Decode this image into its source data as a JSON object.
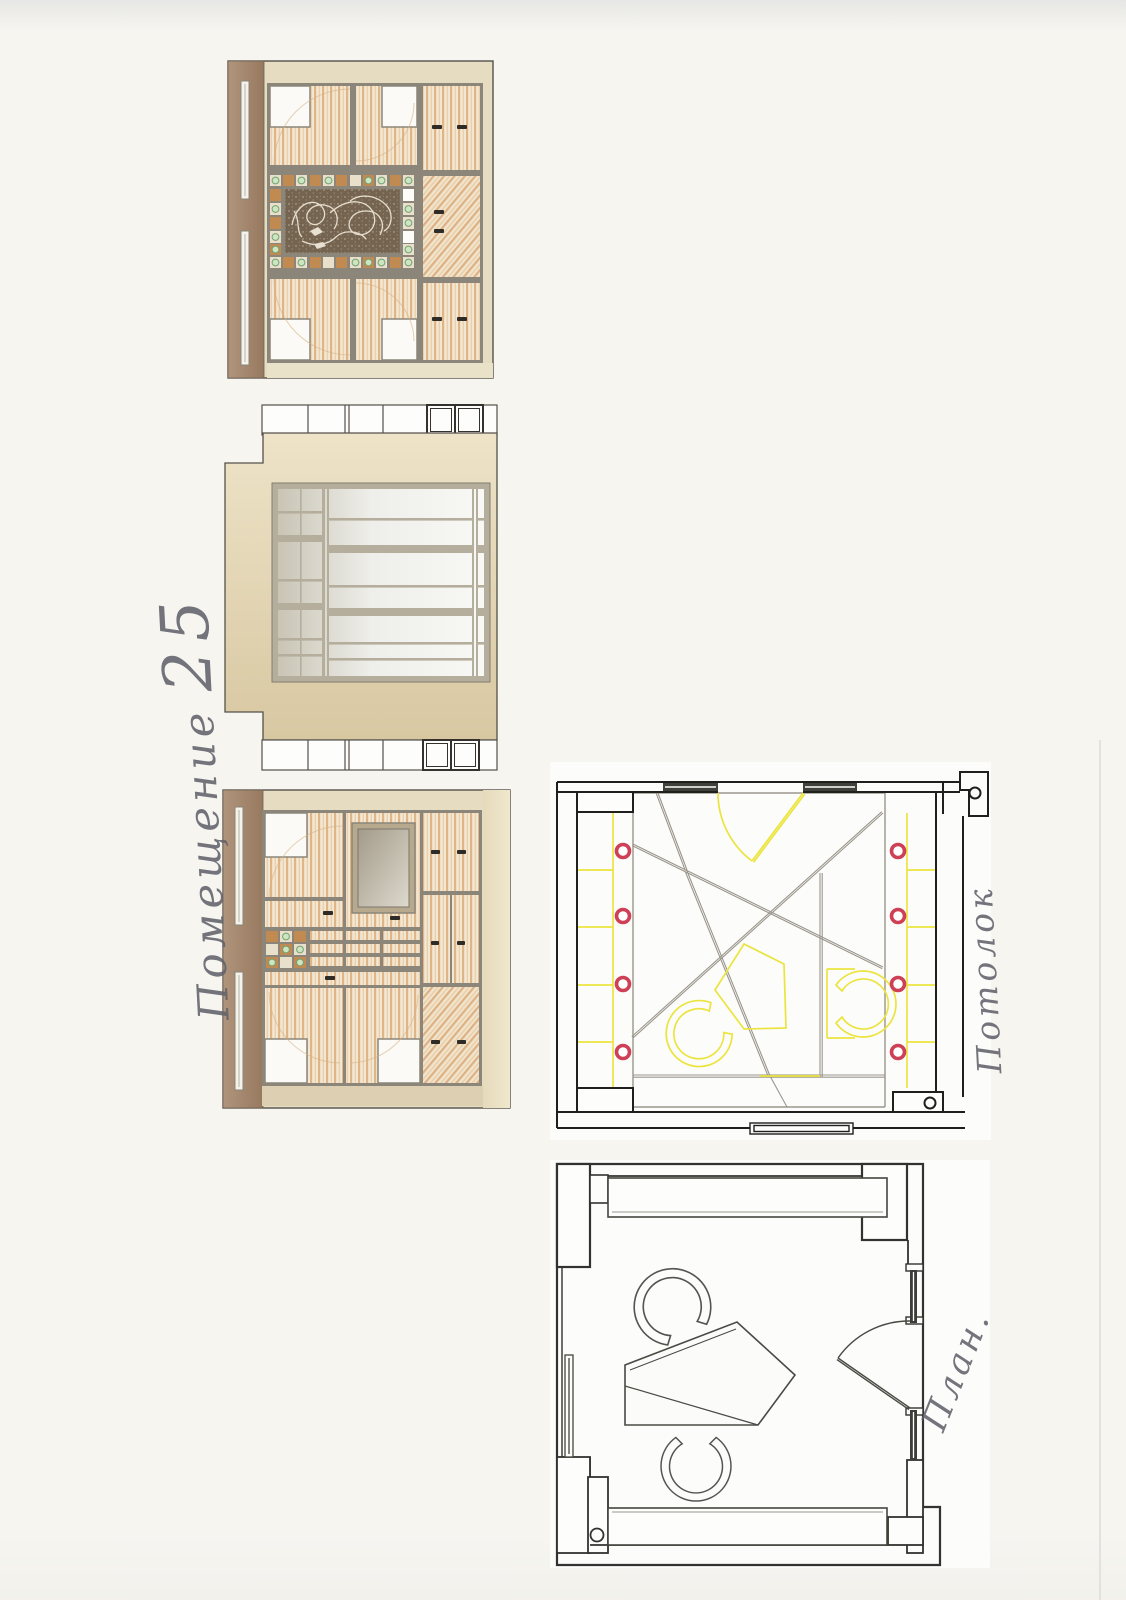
{
  "sheet": {
    "title_word": "Помещение",
    "title_number": "25",
    "ceiling_label": "Потолок",
    "plan_label": "План."
  },
  "colors": {
    "paper": "#f6f5f0",
    "scan_edge": "#e6e6e4",
    "band_brown": "#a58a71",
    "wall_beige_light": "#eee3c8",
    "wall_beige_dark": "#d9c9a3",
    "frame_gray": "#8b8679",
    "wood_light": "#f3e8d4",
    "wood_stripe": "#dfb588",
    "ornament_background": "#756450",
    "ornament_line": "#ece4d4",
    "accent_tile_orange": "#c08a50",
    "accent_dot_green": "#cde6c2",
    "glass_dark": "#c7c2b2",
    "glass_light": "#f7f7f4",
    "mirror_dark": "#a9a191",
    "mirror_light": "#dcd8cc",
    "plan_wall_line": "#1f1f1c",
    "plan_furniture_line": "#4a4a44",
    "ceiling_grid_gray": "#9a968c",
    "highlight_yellow": "#ece43e",
    "downlight_red": "#cd4055",
    "handwriting": "#62626b"
  }
}
